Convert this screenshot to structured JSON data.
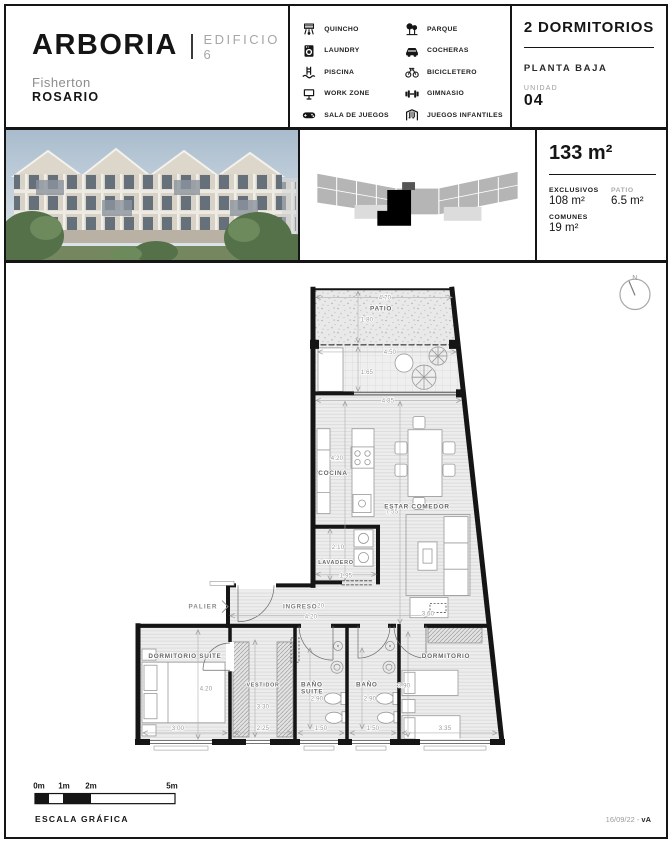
{
  "header": {
    "brand": "ARBORIA",
    "building": "EDIFICIO 6",
    "location1": "Fisherton",
    "location2": "ROSARIO"
  },
  "unit": {
    "type": "2 DORMITORIOS",
    "floor": "PLANTA BAJA",
    "unit_label": "UNIDAD",
    "number": "04"
  },
  "amenities": {
    "left": [
      {
        "icon": "grill-icon",
        "label": "QUINCHO"
      },
      {
        "icon": "laundry-icon",
        "label": "LAUNDRY"
      },
      {
        "icon": "pool-icon",
        "label": "PISCINA"
      },
      {
        "icon": "workzone-icon",
        "label": "WORK ZONE"
      },
      {
        "icon": "games-icon",
        "label": "SALA DE JUEGOS"
      }
    ],
    "right": [
      {
        "icon": "park-icon",
        "label": "PARQUE"
      },
      {
        "icon": "car-icon",
        "label": "COCHERAS"
      },
      {
        "icon": "bike-icon",
        "label": "BICICLETERO"
      },
      {
        "icon": "gym-icon",
        "label": "GIMNASIO"
      },
      {
        "icon": "playground-icon",
        "label": "JUEGOS INFANTILES"
      }
    ]
  },
  "areas": {
    "total": "133 m²",
    "exclusivos_label": "EXCLUSIVOS",
    "exclusivos_value": "108 m²",
    "patio_label": "PATIO",
    "patio_value": "6.5 m²",
    "comunes_label": "COMUNES",
    "comunes_value": "19 m²"
  },
  "plan": {
    "labels": {
      "north": "N",
      "patio": "PATIO",
      "cocina": "COCINA",
      "estar": "ESTAR COMEDOR",
      "lavadero": "LAVADERO",
      "palier": "PALIER",
      "ingreso": "INGRESO",
      "suite": "DORMITORIO SUITE",
      "vestidor": "VESTIDOR",
      "banio_s1": "BAÑO",
      "banio_s2": "SUITE",
      "banio": "BAÑO",
      "dormitorio": "DORMITORIO"
    },
    "dims": {
      "patio_w": "4.70",
      "patio_h": "1.80",
      "terraza_w": "4.50",
      "terraza_h": "1.65",
      "living_w": "4.85",
      "cocina_h": "4.20",
      "living_h": "7.55",
      "lavadero_h": "2.10",
      "lavadero_w": "1.95",
      "ingreso_w": "1.20",
      "ingreso_largo": "4.20",
      "living_w2": "3.60",
      "suite_h": "4.20",
      "suite_w": "3.00",
      "vestidor_h": "3.30",
      "vestidor_w": "2.25",
      "banio_s_h": "2.90",
      "banio_s_w": "1.50",
      "banio_h": "2.90",
      "banio_w": "1.50",
      "dorm_h": "3.90",
      "dorm_w": "3.35"
    }
  },
  "footer": {
    "scale": [
      "0m",
      "1m",
      "2m",
      "5m"
    ],
    "caption": "ESCALA GRÁFICA",
    "date": "16/09/22 - ",
    "version": "vA"
  }
}
